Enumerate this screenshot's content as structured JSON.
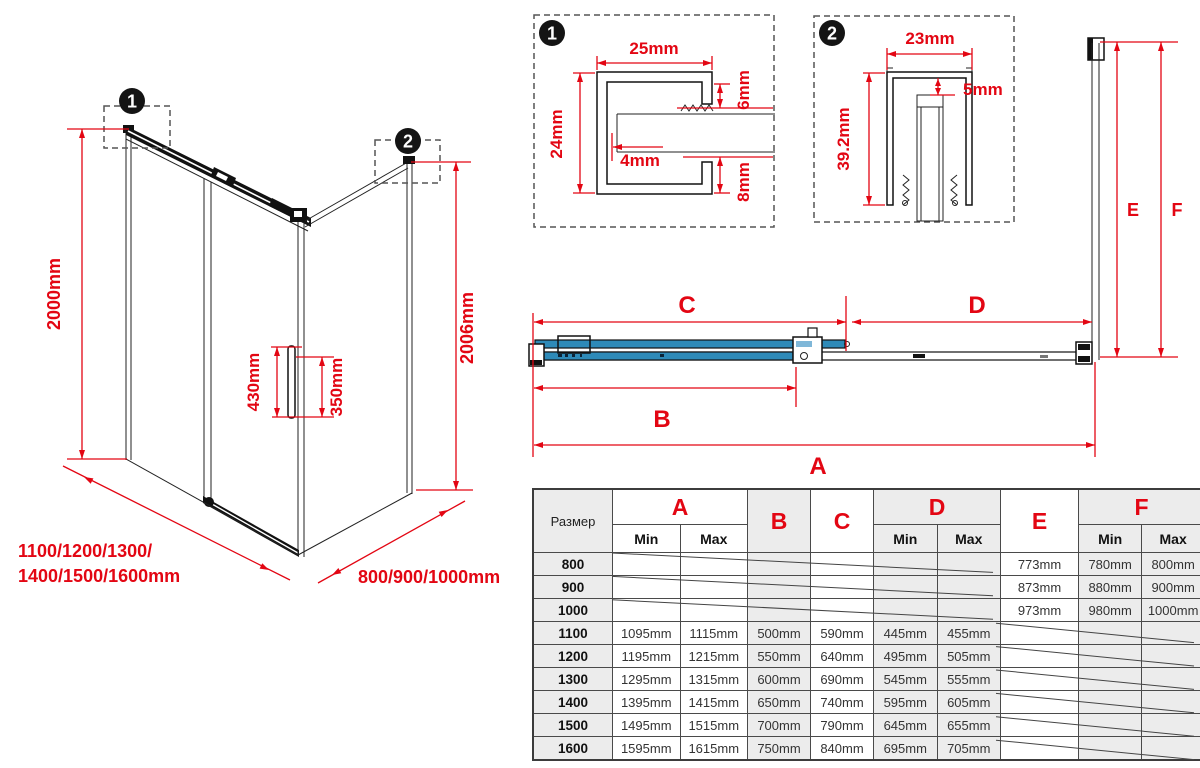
{
  "colors": {
    "red": "#e30613",
    "blue": "#2e8ab8",
    "table_gray": "#ececec"
  },
  "badges": {
    "one": "1",
    "two": "2"
  },
  "iso": {
    "height": "2000mm",
    "height_right": "2006mm",
    "handle_length": "430mm",
    "handle_spacing": "350mm",
    "front_widths_line1": "1100/1200/1300/",
    "front_widths_line2": "1400/1500/1600mm",
    "side_widths": "800/900/1000mm"
  },
  "detail1": {
    "width": "25mm",
    "height": "24mm",
    "top_gap": "6mm",
    "wall": "4mm",
    "bottom_gap": "8mm"
  },
  "detail2": {
    "width": "23mm",
    "gap": "5mm",
    "height": "39.2mm"
  },
  "plan": {
    "dims": {
      "a": "A",
      "b": "B",
      "c": "C",
      "d": "D",
      "e": "E",
      "f": "F"
    }
  },
  "table": {
    "size_header": "Размер",
    "min_label": "Min",
    "max_label": "Max",
    "col_letters": [
      "A",
      "B",
      "C",
      "D",
      "E",
      "F"
    ],
    "rows": [
      {
        "size": "800",
        "a_min": "",
        "a_max": "",
        "b": "",
        "c": "",
        "d_min": "",
        "d_max": "",
        "e": "773mm",
        "f_min": "780mm",
        "f_max": "800mm"
      },
      {
        "size": "900",
        "a_min": "",
        "a_max": "",
        "b": "",
        "c": "",
        "d_min": "",
        "d_max": "",
        "e": "873mm",
        "f_min": "880mm",
        "f_max": "900mm"
      },
      {
        "size": "1000",
        "a_min": "",
        "a_max": "",
        "b": "",
        "c": "",
        "d_min": "",
        "d_max": "",
        "e": "973mm",
        "f_min": "980mm",
        "f_max": "1000mm"
      },
      {
        "size": "1100",
        "a_min": "1095mm",
        "a_max": "1115mm",
        "b": "500mm",
        "c": "590mm",
        "d_min": "445mm",
        "d_max": "455mm",
        "e": "",
        "f_min": "",
        "f_max": ""
      },
      {
        "size": "1200",
        "a_min": "1195mm",
        "a_max": "1215mm",
        "b": "550mm",
        "c": "640mm",
        "d_min": "495mm",
        "d_max": "505mm",
        "e": "",
        "f_min": "",
        "f_max": ""
      },
      {
        "size": "1300",
        "a_min": "1295mm",
        "a_max": "1315mm",
        "b": "600mm",
        "c": "690mm",
        "d_min": "545mm",
        "d_max": "555mm",
        "e": "",
        "f_min": "",
        "f_max": ""
      },
      {
        "size": "1400",
        "a_min": "1395mm",
        "a_max": "1415mm",
        "b": "650mm",
        "c": "740mm",
        "d_min": "595mm",
        "d_max": "605mm",
        "e": "",
        "f_min": "",
        "f_max": ""
      },
      {
        "size": "1500",
        "a_min": "1495mm",
        "a_max": "1515mm",
        "b": "700mm",
        "c": "790mm",
        "d_min": "645mm",
        "d_max": "655mm",
        "e": "",
        "f_min": "",
        "f_max": ""
      },
      {
        "size": "1600",
        "a_min": "1595mm",
        "a_max": "1615mm",
        "b": "750mm",
        "c": "840mm",
        "d_min": "695mm",
        "d_max": "705mm",
        "e": "",
        "f_min": "",
        "f_max": ""
      }
    ]
  }
}
